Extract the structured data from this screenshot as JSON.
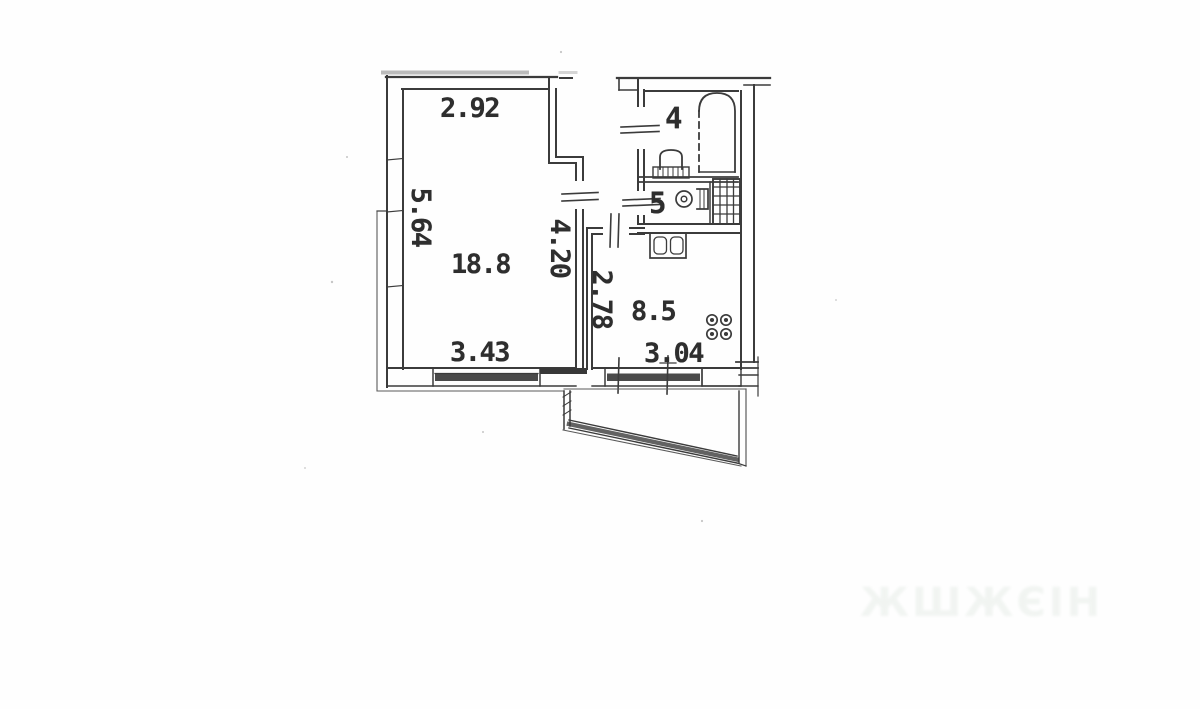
{
  "document_type": "apartment-floor-plan-scan",
  "labels": {
    "living_width_top": "2.92",
    "living_depth_left": "5.64",
    "living_area": "18.8",
    "living_depth_right": "4.20",
    "living_width_bottom": "3.43",
    "kitchen_depth_left": "2.78",
    "kitchen_area": "8.5",
    "kitchen_width_bottom": "3.04",
    "bathroom_number": "4",
    "toilet_number": "5"
  },
  "rooms": [
    {
      "name": "living-room",
      "area_m2": "18.8",
      "width_top_m": "2.92",
      "depth_left_m": "5.64",
      "width_bottom_m": "3.43",
      "depth_right_m": "4.20"
    },
    {
      "name": "kitchen",
      "area_m2": "8.5",
      "depth_m": "2.78",
      "width_m": "3.04",
      "fixtures": [
        "sink",
        "stove-4-burners"
      ]
    },
    {
      "name": "bathroom",
      "number": "4",
      "fixtures": [
        "bathtub",
        "washbasin"
      ]
    },
    {
      "name": "toilet",
      "number": "5",
      "fixtures": [
        "wc",
        "ventilation-shaft"
      ]
    },
    {
      "name": "balcony",
      "fixtures": [
        "slanted-railing"
      ]
    }
  ],
  "watermark": {
    "text": "ЖШЖЄІН"
  },
  "colors": {
    "ink": "#3b3b3b",
    "wall_dark": "#353535",
    "paper": "#ffffff",
    "watermark": "#e7ede8"
  }
}
